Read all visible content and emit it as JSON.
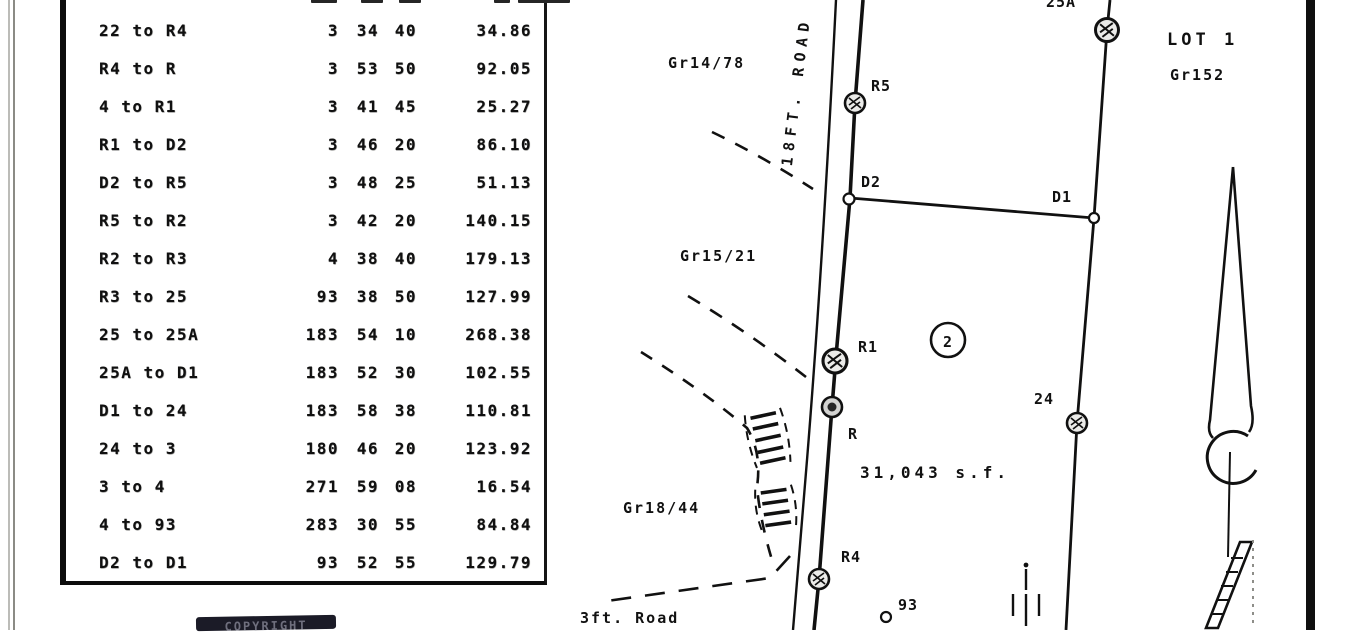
{
  "document": {
    "kind": "scanned survey plat",
    "stamp_label": "COPYRIGHT"
  },
  "traverse_table": {
    "columns": [
      "course",
      "degrees",
      "minutes",
      "seconds",
      "distance"
    ],
    "rows": [
      {
        "course": "22 to R4",
        "deg": "3",
        "min": "34",
        "sec": "40",
        "dist": "34.86"
      },
      {
        "course": "R4 to R",
        "deg": "3",
        "min": "53",
        "sec": "50",
        "dist": "92.05"
      },
      {
        "course": "4 to R1",
        "deg": "3",
        "min": "41",
        "sec": "45",
        "dist": "25.27"
      },
      {
        "course": "R1 to D2",
        "deg": "3",
        "min": "46",
        "sec": "20",
        "dist": "86.10"
      },
      {
        "course": "D2 to R5",
        "deg": "3",
        "min": "48",
        "sec": "25",
        "dist": "51.13"
      },
      {
        "course": "R5 to R2",
        "deg": "3",
        "min": "42",
        "sec": "20",
        "dist": "140.15"
      },
      {
        "course": "R2 to R3",
        "deg": "4",
        "min": "38",
        "sec": "40",
        "dist": "179.13"
      },
      {
        "course": "R3 to 25",
        "deg": "93",
        "min": "38",
        "sec": "50",
        "dist": "127.99"
      },
      {
        "course": "25 to 25A",
        "deg": "183",
        "min": "54",
        "sec": "10",
        "dist": "268.38"
      },
      {
        "course": "25A to D1",
        "deg": "183",
        "min": "52",
        "sec": "30",
        "dist": "102.55"
      },
      {
        "course": "D1 to 24",
        "deg": "183",
        "min": "58",
        "sec": "38",
        "dist": "110.81"
      },
      {
        "course": "24 to 3",
        "deg": "180",
        "min": "46",
        "sec": "20",
        "dist": "123.92"
      },
      {
        "course": "3 to 4",
        "deg": "271",
        "min": "59",
        "sec": "08",
        "dist": "16.54"
      },
      {
        "course": "4 to 93",
        "deg": "283",
        "min": "30",
        "sec": "55",
        "dist": "84.84"
      },
      {
        "course": "D2 to D1",
        "deg": "93",
        "min": "52",
        "sec": "55",
        "dist": "129.79"
      }
    ]
  },
  "map": {
    "road_label": "18FT. ROAD",
    "old_road_label": "3ft. Road",
    "lot": {
      "name": "LOT 1",
      "grant": "Gr152",
      "parcel_number": "2",
      "area": "31,043 s.f."
    },
    "grant_refs": {
      "northwest": "Gr14/78",
      "west": "Gr15/21",
      "southwest": "Gr18/44"
    },
    "point_labels": {
      "r5": "R5",
      "d2": "D2",
      "r1": "R1",
      "r": "R",
      "r4": "R4",
      "p24": "24",
      "d1": "D1",
      "p93": "93",
      "p25a": "25A"
    }
  },
  "colors": {
    "ink": "#161616",
    "paper": "#fdfdfc",
    "stamp_background": "#20202b"
  }
}
